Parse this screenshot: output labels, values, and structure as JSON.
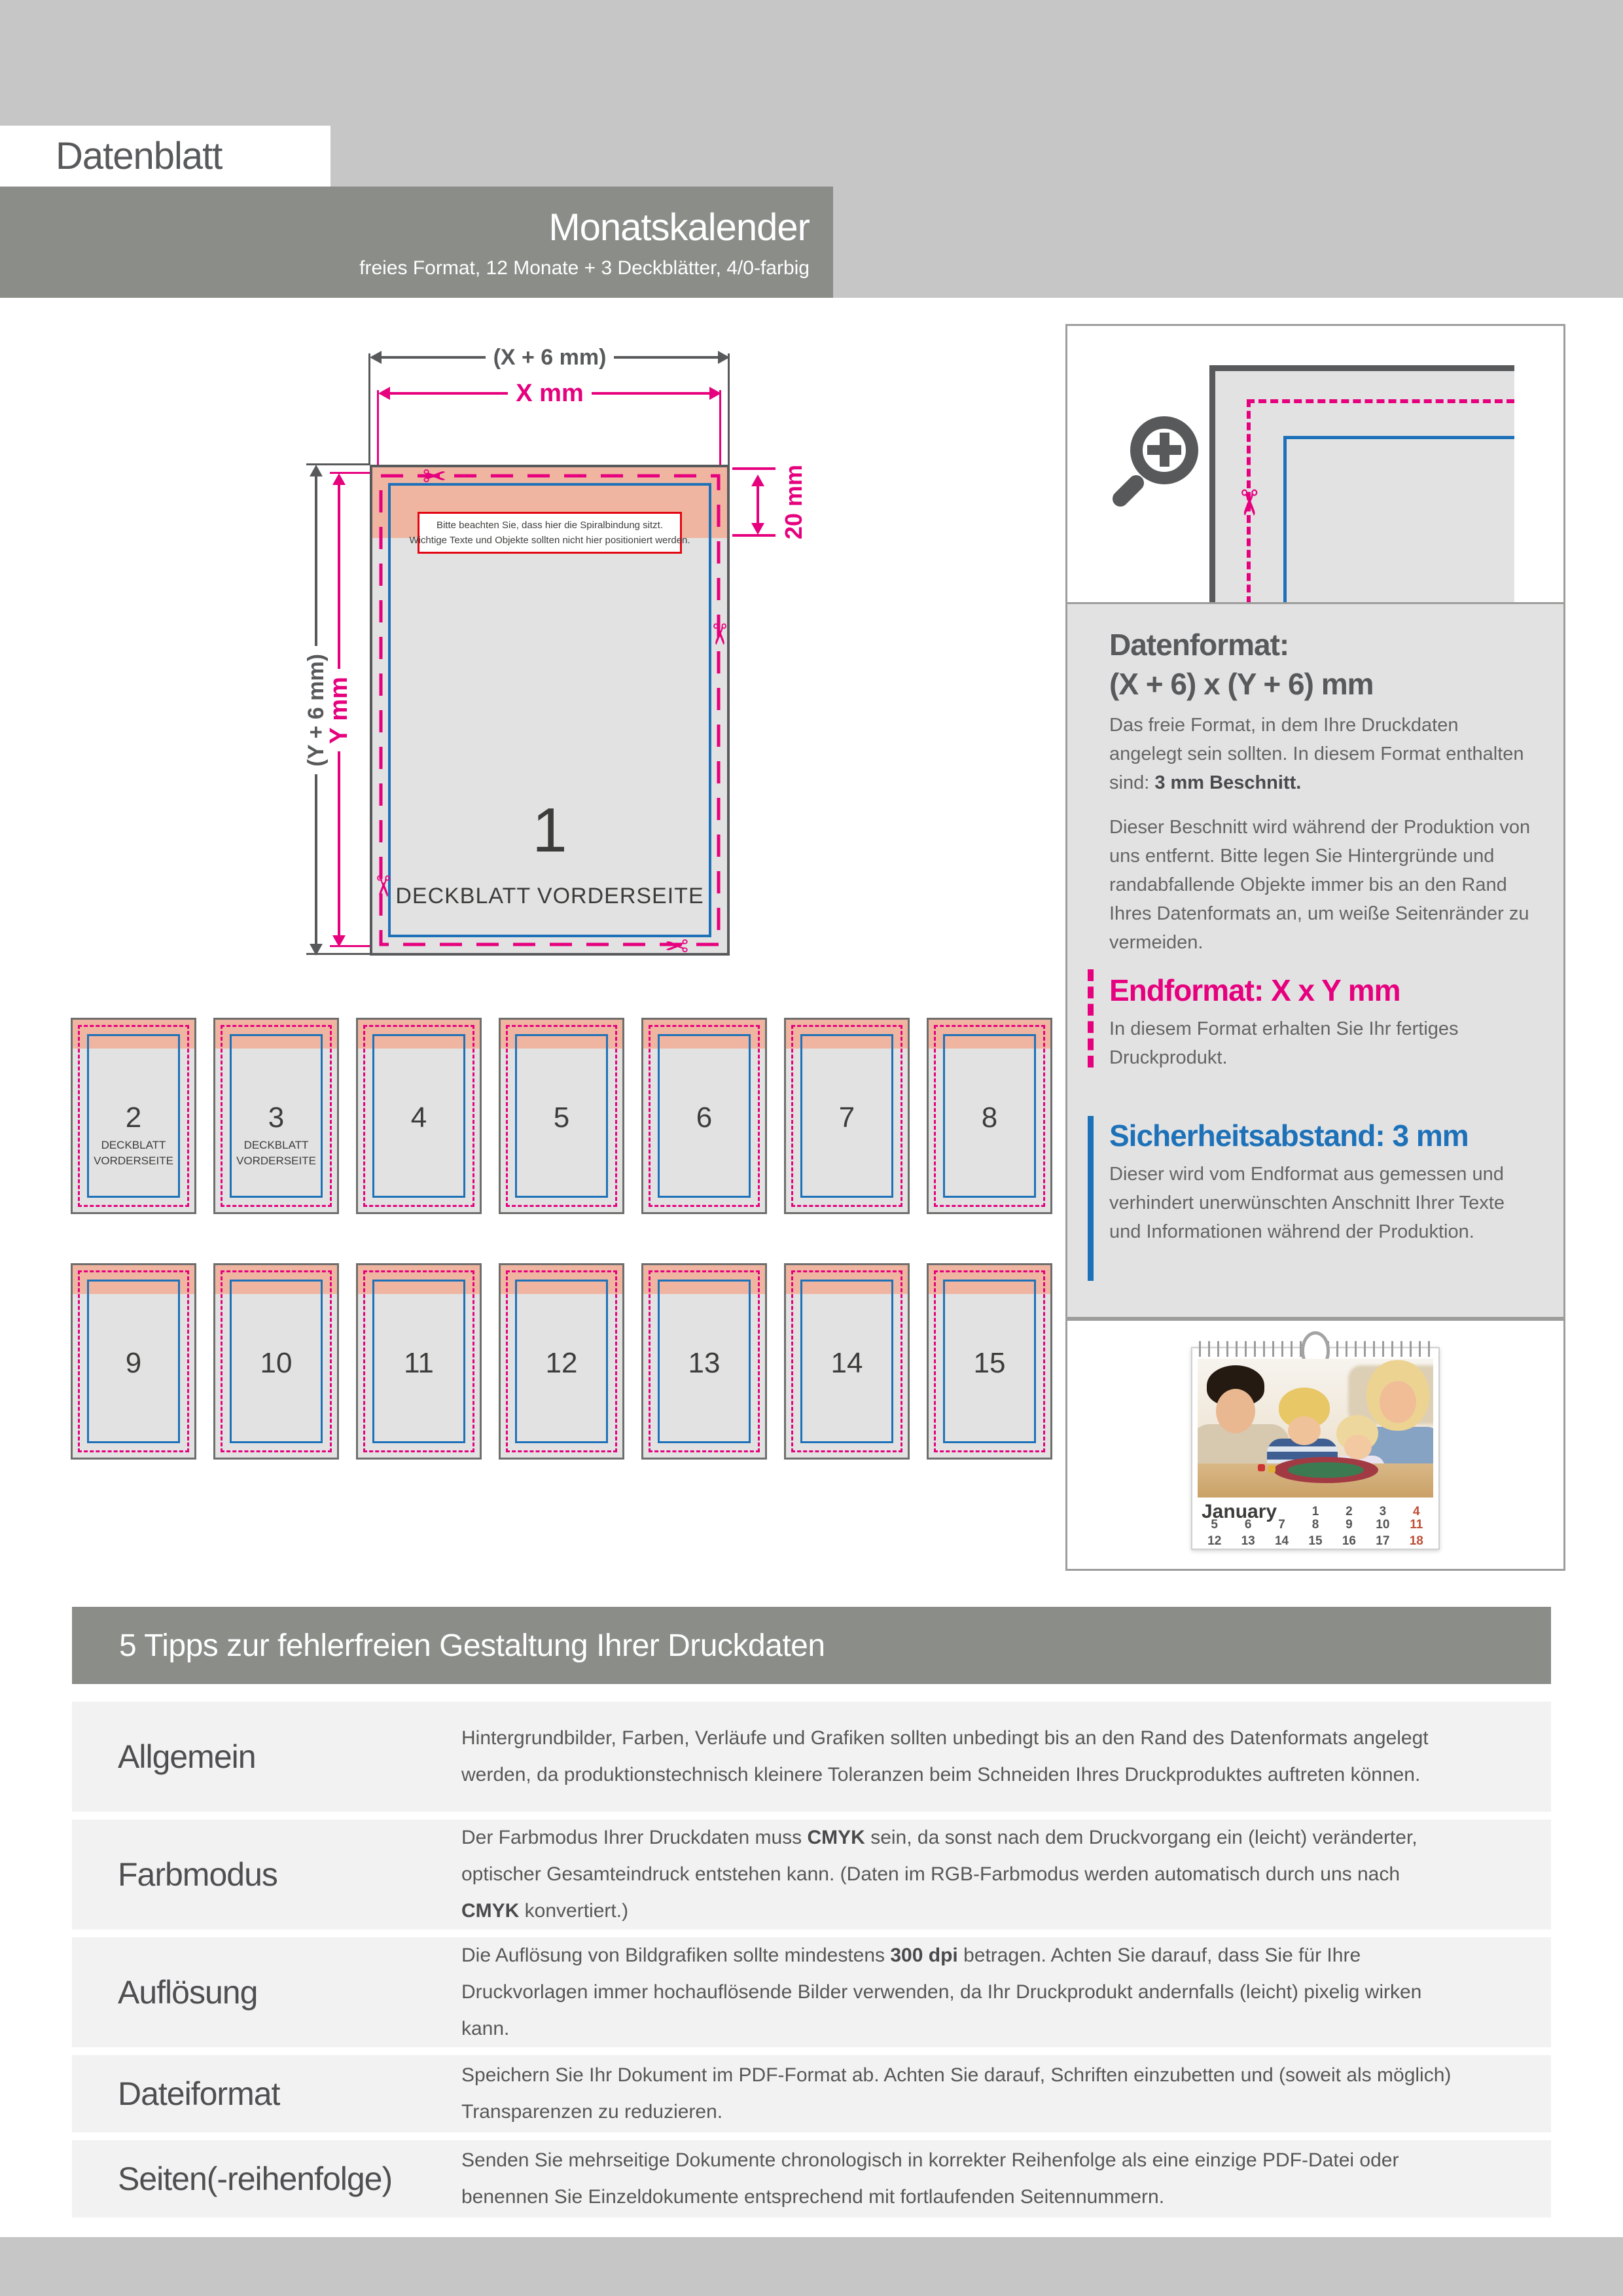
{
  "colors": {
    "magenta": "#e6007e",
    "blue": "#1d71b8",
    "salmon": "#f0b5a1",
    "red": "#e30613",
    "dark_gray": "#58595b",
    "bar_gray": "#8b8d89",
    "light_band": "#c6c6c6",
    "panel_gray": "#e2e2e3",
    "page_fill": "#e2e2e2",
    "row_bg": "#f2f2f3",
    "date_red": "#bf4f38"
  },
  "header": {
    "doc_label": "Datenblatt",
    "product_title": "Monatskalender",
    "product_subtitle": "freies Format, 12 Monate + 3 Deckblätter, 4/0-farbig"
  },
  "diagram": {
    "dim_outer_width": "(X + 6 mm)",
    "dim_inner_width": "X mm",
    "dim_outer_height": "(Y + 6 mm)",
    "dim_inner_height": "Y mm",
    "dim_band": "20 mm",
    "note_line1": "Bitte beachten Sie, dass hier die Spiralbindung sitzt.",
    "note_line2": "Wichtige Texte und Objekte sollten nicht hier positioniert werden.",
    "page_number": "1",
    "page_label": "DECKBLATT VORDERSEITE",
    "scissors_glyph": "✂"
  },
  "pages": {
    "items": [
      {
        "number": "2",
        "label": "DECKBLATT\nVORDERSEITE"
      },
      {
        "number": "3",
        "label": "DECKBLATT\nVORDERSEITE"
      },
      {
        "number": "4",
        "label": ""
      },
      {
        "number": "5",
        "label": ""
      },
      {
        "number": "6",
        "label": ""
      },
      {
        "number": "7",
        "label": ""
      },
      {
        "number": "8",
        "label": ""
      },
      {
        "number": "9",
        "label": ""
      },
      {
        "number": "10",
        "label": ""
      },
      {
        "number": "11",
        "label": ""
      },
      {
        "number": "12",
        "label": ""
      },
      {
        "number": "13",
        "label": ""
      },
      {
        "number": "14",
        "label": ""
      },
      {
        "number": "15",
        "label": ""
      }
    ]
  },
  "info_panel": {
    "datenformat_title": "Datenformat:",
    "datenformat_formula": "(X + 6) x (Y + 6) mm",
    "datenformat_p1": [
      {
        "t": "Das freie Format, in dem Ihre Druckdaten angelegt sein sollten. In diesem Format enthalten sind: "
      },
      {
        "t": "3 mm Beschnitt.",
        "b": true
      }
    ],
    "datenformat_p2": "Dieser Beschnitt wird während der Produktion von uns entfernt. Bitte legen Sie Hintergründe und randabfallende Objekte immer bis an den Rand Ihres Datenformats an, um weiße Seitenränder zu vermeiden.",
    "endformat_title": "Endformat: X x Y mm",
    "endformat_text": "In diesem Format erhalten Sie Ihr fertiges Druckprodukt.",
    "sicherheit_title": "Sicherheitsabstand: 3 mm",
    "sicherheit_text": "Dieser wird vom Endformat aus gemessen und verhindert unerwünschten Anschnitt Ihrer Texte und Informationen während der Produktion."
  },
  "calendar": {
    "month": "January",
    "weeks": [
      [
        "1",
        "2",
        "3",
        "4"
      ],
      [
        "5",
        "6",
        "7",
        "8",
        "9",
        "10",
        "11"
      ],
      [
        "12",
        "13",
        "14",
        "15",
        "16",
        "17",
        "18"
      ]
    ]
  },
  "tips": {
    "title": "5 Tipps zur fehlerfreien Gestaltung Ihrer Druckdaten",
    "rows": [
      {
        "label": "Allgemein",
        "segments": [
          {
            "t": "Hintergrundbilder, Farben, Verläufe und Grafiken sollten unbedingt bis an den Rand des Datenformats angelegt werden, da produktionstechnisch kleinere Toleranzen beim Schneiden Ihres Druckproduktes auftreten können."
          }
        ]
      },
      {
        "label": "Farbmodus",
        "segments": [
          {
            "t": "Der Farbmodus Ihrer Druckdaten muss "
          },
          {
            "t": "CMYK",
            "b": true
          },
          {
            "t": " sein, da sonst nach dem Druckvorgang ein (leicht) veränderter, optischer Gesamteindruck entstehen kann. (Daten im RGB-Farbmodus werden automatisch durch uns nach "
          },
          {
            "t": "CMYK",
            "b": true
          },
          {
            "t": " konvertiert.)"
          }
        ]
      },
      {
        "label": "Auflösung",
        "segments": [
          {
            "t": "Die Auflösung von Bildgrafiken sollte mindestens "
          },
          {
            "t": "300 dpi",
            "b": true
          },
          {
            "t": " betragen. Achten Sie darauf, dass Sie für Ihre Druckvorlagen immer hochauflösende Bilder verwenden, da Ihr Druckprodukt andernfalls (leicht) pixelig wirken kann."
          }
        ]
      },
      {
        "label": "Dateiformat",
        "segments": [
          {
            "t": "Speichern Sie Ihr Dokument im PDF-Format ab. Achten Sie darauf, Schriften einzubetten und (soweit als möglich) Transparenzen zu reduzieren."
          }
        ]
      },
      {
        "label": "Seiten(-reihenfolge)",
        "segments": [
          {
            "t": "Senden Sie mehrseitige Dokumente chronologisch in korrekter Reihenfolge als eine einzige PDF-Datei oder benennen Sie Einzeldokumente entsprechend mit fortlaufenden Seitennummern."
          }
        ]
      }
    ]
  }
}
